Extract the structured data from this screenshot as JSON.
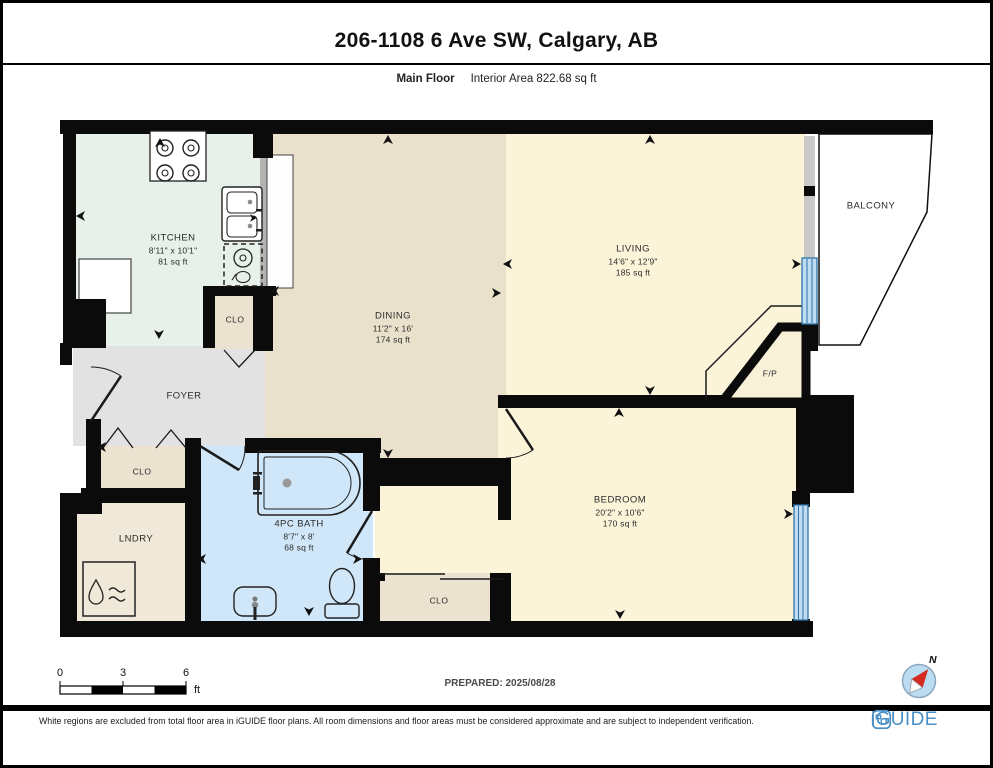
{
  "header": {
    "title": "206-1108 6 Ave SW, Calgary, AB",
    "floor_label": "Main Floor",
    "area_label": "Interior Area 822.68 sq ft"
  },
  "plan": {
    "rooms": [
      {
        "name": "KITCHEN",
        "dims": "8'11\" x 10'1\"",
        "area": "81 sq ft"
      },
      {
        "name": "DINING",
        "dims": "11'2\" x 16'",
        "area": "174 sq ft"
      },
      {
        "name": "LIVING",
        "dims": "14'6\" x 12'9\"",
        "area": "185 sq ft"
      },
      {
        "name": "BEDROOM",
        "dims": "20'2\" x 10'6\"",
        "area": "170 sq ft"
      },
      {
        "name": "4PC BATH",
        "dims": "8'7\" x 8'",
        "area": "68 sq ft"
      },
      {
        "name": "FOYER"
      },
      {
        "name": "LNDRY"
      },
      {
        "name": "BALCONY"
      },
      {
        "name": "CLO"
      },
      {
        "name": "CLO"
      },
      {
        "name": "CLO"
      },
      {
        "name": "F/P"
      }
    ],
    "colors": {
      "kitchen": "#e7f1ea",
      "dining": "#e9e1cc",
      "living": "#fbf4d9",
      "bedroom": "#fbf4d9",
      "vestibule": "#fbf4d9",
      "fireplace": "#f8f1d8",
      "bath": "#cfe7f8",
      "foyer": "#e2e2e2",
      "closet": "#ebe3d0",
      "laundry": "#f0e8d8",
      "window": "#bfdcf2",
      "window_frame": "#2e74a8",
      "wall": "#0b0b0b",
      "balcony": "#ffffff"
    }
  },
  "footer": {
    "scale_ticks": [
      "0",
      "3",
      "6"
    ],
    "scale_unit": "ft",
    "prepared_label": "PREPARED: 2025/08/28",
    "compass_label": "N",
    "disclaimer": "White regions are excluded from total floor area in iGUIDE floor plans. All room dimensions and floor areas must be considered approximate and are subject to independent verification.",
    "brand": "iGUIDE"
  }
}
